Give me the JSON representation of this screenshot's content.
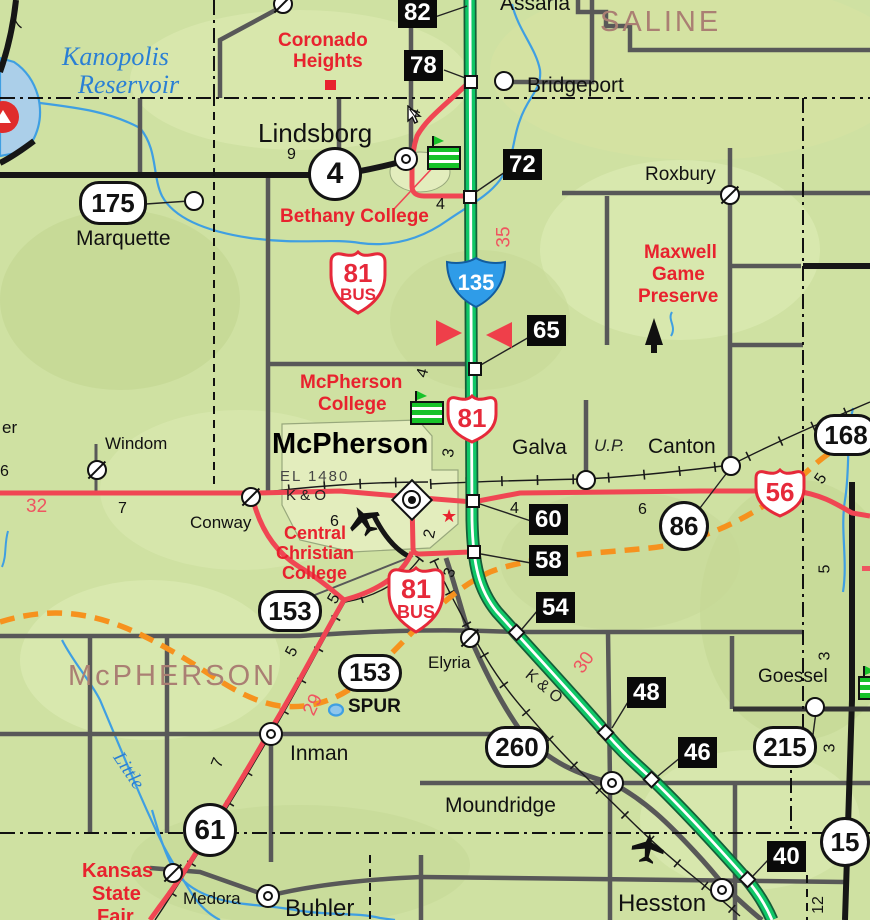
{
  "colors": {
    "highway_red": "#f04653",
    "freeway_green": "#10c767",
    "orange_route": "#f6921e",
    "water_blue": "#3f9fe2",
    "county_label_brown": "#aa7f73",
    "poi_red": "#e8222e",
    "interstate_blue": "#2f9ce8"
  },
  "counties": {
    "saline": "SALINE",
    "mcpherson": "McPHERSON"
  },
  "water": {
    "reservoir_line1": "Kanopolis",
    "reservoir_line2": "Reservoir",
    "little": "Little"
  },
  "cities": {
    "assaria": "Assaria",
    "bridgeport": "Bridgeport",
    "lindsborg": "Lindsborg",
    "marquette": "Marquette",
    "roxbury": "Roxbury",
    "windom": "Windom",
    "conway": "Conway",
    "galva": "Galva",
    "canton": "Canton",
    "mcpherson": "McPherson",
    "elyria": "Elyria",
    "goessel": "Goessel",
    "inman": "Inman",
    "moundridge": "Moundridge",
    "medora": "Medora",
    "buhler": "Buhler",
    "hesston": "Hesston",
    "edge_partial": "er"
  },
  "pois": {
    "coronado": [
      "Coronado",
      "Heights"
    ],
    "bethany": "Bethany College",
    "mcpherson_college": [
      "McPherson",
      "College"
    ],
    "central_christian": [
      "Central",
      "Christian",
      "College"
    ],
    "maxwell": [
      "Maxwell",
      "Game",
      "Preserve"
    ],
    "state_fair": [
      "Kansas",
      "State",
      "Fair"
    ]
  },
  "railroads": {
    "ko_west": "K & O",
    "ko_southeast": "K & O",
    "union_pacific": "U.P."
  },
  "elevation_label": "EL 1480",
  "shields": {
    "i135": "135",
    "us81": "81",
    "us56": "56",
    "bus81_north": {
      "num": "81",
      "suffix": "BUS"
    },
    "bus81_city": {
      "num": "81",
      "suffix": "BUS"
    },
    "k4": "4",
    "k175": "175",
    "k86": "86",
    "k168": "168",
    "k153": "153",
    "k153_spur": {
      "num": "153",
      "label": "SPUR"
    },
    "k260": "260",
    "k215": "215",
    "k61": "61",
    "k15": "15"
  },
  "exits": {
    "e82": "82",
    "e78": "78",
    "e72": "72",
    "e65": "65",
    "e60": "60",
    "e58": "58",
    "e54": "54",
    "e48": "48",
    "e46": "46",
    "e40": "40"
  },
  "mileposts": {
    "i135_mp35": "35",
    "i135_mp30": "30",
    "us56_mp32": "32",
    "k61_mp29": "29"
  },
  "distances": {
    "d7_nw": "7",
    "d9_lindsborg": "9",
    "d4_bethany_n": "4",
    "d4_bethany_s": "4",
    "d4_mcpherson_college": "4",
    "d3_mcpherson": "3",
    "d4_galva": "4",
    "d6_galva": "6",
    "d6_mcpherson_w": "6",
    "d2_biz": "2",
    "d3_biz": "3",
    "d5_k153": "5",
    "d5_k61": "5",
    "d7_conway": "7",
    "d7_inman": "7",
    "d5_canton_e": "5",
    "d5_k15_n": "5",
    "d3_goessel_n": "3",
    "d3_goessel_s": "3",
    "d12_hesston": "12",
    "d6_edge_w": "6"
  }
}
